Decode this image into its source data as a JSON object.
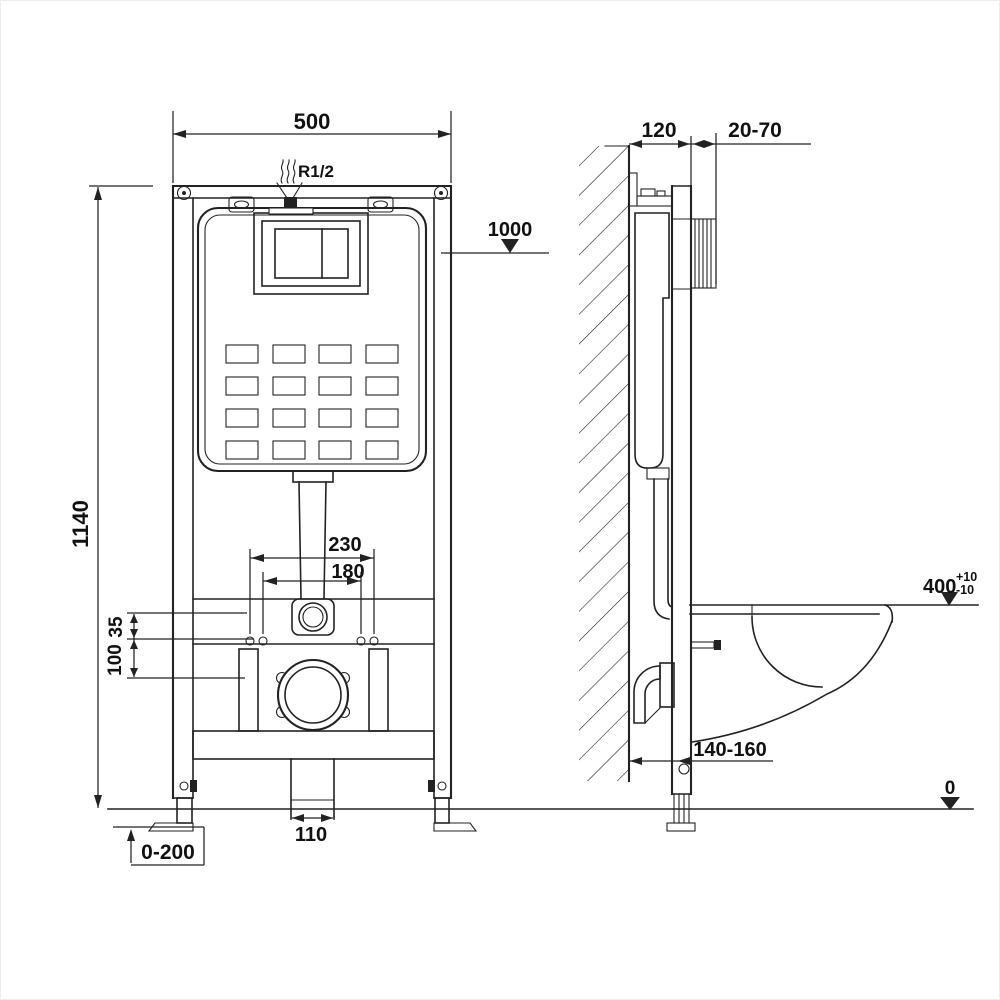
{
  "front_view": {
    "frame_width": "500",
    "water_supply": "R1/2",
    "level_marker": "1000",
    "frame_height": "1140",
    "fixing_span_outer": "230",
    "fixing_span_inner": "180",
    "offset_small": "35",
    "offset_large": "100",
    "outlet_width": "110",
    "leg_range": "0-200"
  },
  "side_view": {
    "frame_depth": "120",
    "finish_range": "20-70",
    "bowl_height": "400",
    "bowl_tol_plus": "+10",
    "bowl_tol_minus": "-10",
    "outlet_distance": "140-160",
    "floor_level": "0"
  },
  "colors": {
    "line": "#222222",
    "text": "#111111",
    "background": "#ffffff"
  }
}
